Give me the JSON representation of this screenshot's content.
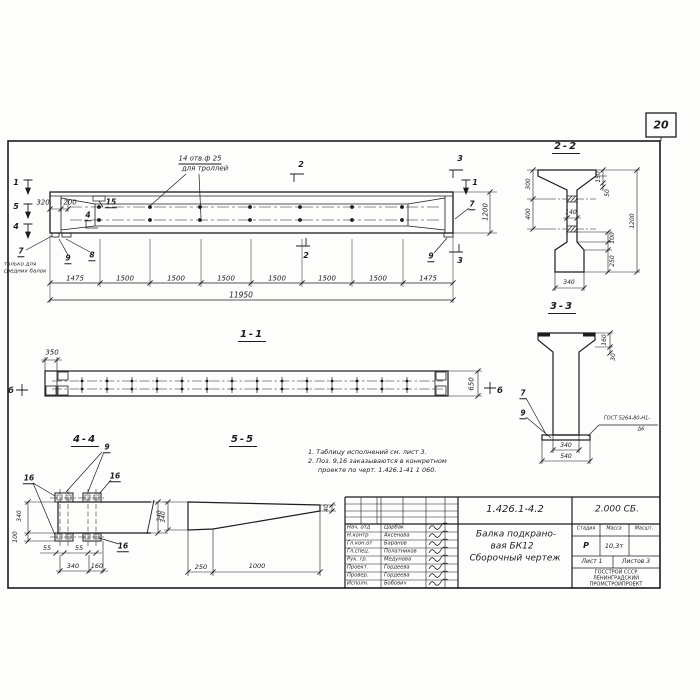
{
  "page_number": "20",
  "main_view": {
    "callout_line1": "14 отв.ф 25",
    "callout_line2": "для троллей",
    "cut1": "1",
    "cut5": "5",
    "cut4": "4",
    "cut2": "2",
    "cut3": "3",
    "cut1_right": "1",
    "dim_320": "320",
    "dim_200": "200",
    "pos_15": "15",
    "pos_4": "4",
    "pos_7": "7",
    "pos_7_note1": "только для",
    "pos_7_note2": "средних балок",
    "pos_9": "9",
    "pos_8": "8",
    "pos_9_right": "9",
    "pos_7_right": "7",
    "dim_height": "1200",
    "segments": [
      "1475",
      "1500",
      "1500",
      "1500",
      "1500",
      "1500",
      "1500",
      "1475"
    ],
    "dim_total": "11950"
  },
  "section_22": {
    "title": "2-2",
    "dim_300": "300",
    "dim_400": "400",
    "dim_150": "150",
    "dim_50": "50",
    "dim_1200": "1200",
    "dim_100": "100",
    "dim_250": "250",
    "dim_140": "140",
    "dim_340": "340"
  },
  "section_33": {
    "title": "3-3",
    "dim_160": "160",
    "dim_30": "30",
    "pos_7": "7",
    "pos_9": "9",
    "weld_note": "ГОСТ 5264-80-Н1-",
    "weld_note2": "Δ6",
    "dim_340": "340",
    "dim_540": "540"
  },
  "section_11": {
    "title": "1-1",
    "dim_350": "350",
    "dim_650": "650",
    "marker_b_left": "б",
    "marker_b_right": "б"
  },
  "detail_44": {
    "title": "4-4",
    "pos_9": "9",
    "pos_16_a": "16",
    "pos_16_b": "16",
    "pos_16_c": "16",
    "dim_340_left": "340",
    "dim_100": "100",
    "dim_55_a": "55",
    "dim_55_b": "55",
    "dim_340_bottom": "340",
    "dim_160": "160",
    "dim_340_right": "340"
  },
  "detail_55": {
    "title": "5-5",
    "dim_340": "340",
    "dim_250": "250",
    "dim_1000": "1000",
    "dim_40": "40"
  },
  "notes": {
    "line1": "1. Таблицу исполнений см. лист 3.",
    "line2": "2. Поз. 9,16 заказываются в конкретном",
    "line3": "проекте по черт. 1.426.1-41 1 060."
  },
  "title_block": {
    "doc_number": "1.426.1-4.2",
    "doc_code": "2.000 СБ.",
    "title_line1": "Балка подкрано-",
    "title_line2": "вая БК12",
    "title_line3": "Сборочный чертеж",
    "staff": [
      {
        "role": "Нач. отд",
        "name": "Царбак"
      },
      {
        "role": "Н.контр",
        "name": "Аксенова"
      },
      {
        "role": "Гл.кон.от",
        "name": "Баранов"
      },
      {
        "role": "Гл.спец.",
        "name": "Полатников"
      },
      {
        "role": "Рук. гр.",
        "name": "Медунова"
      },
      {
        "role": "Проект.",
        "name": "Гордеева"
      },
      {
        "role": "Провер.",
        "name": "Гордеева"
      },
      {
        "role": "Исполн.",
        "name": "Бобович"
      }
    ],
    "stage_header": "Стадия",
    "mass_header": "Масса",
    "scale_header": "Масшт.",
    "stage": "Р",
    "mass": "10,3т",
    "sheet": "Лист 1",
    "sheets": "Листов 3",
    "org_line1": "ГОССТРОЙ СССР",
    "org_line2": "ЛЕНИНГРАДСКИЙ",
    "org_line3": "ПРОМСТРОЙПРОЕКТ"
  }
}
